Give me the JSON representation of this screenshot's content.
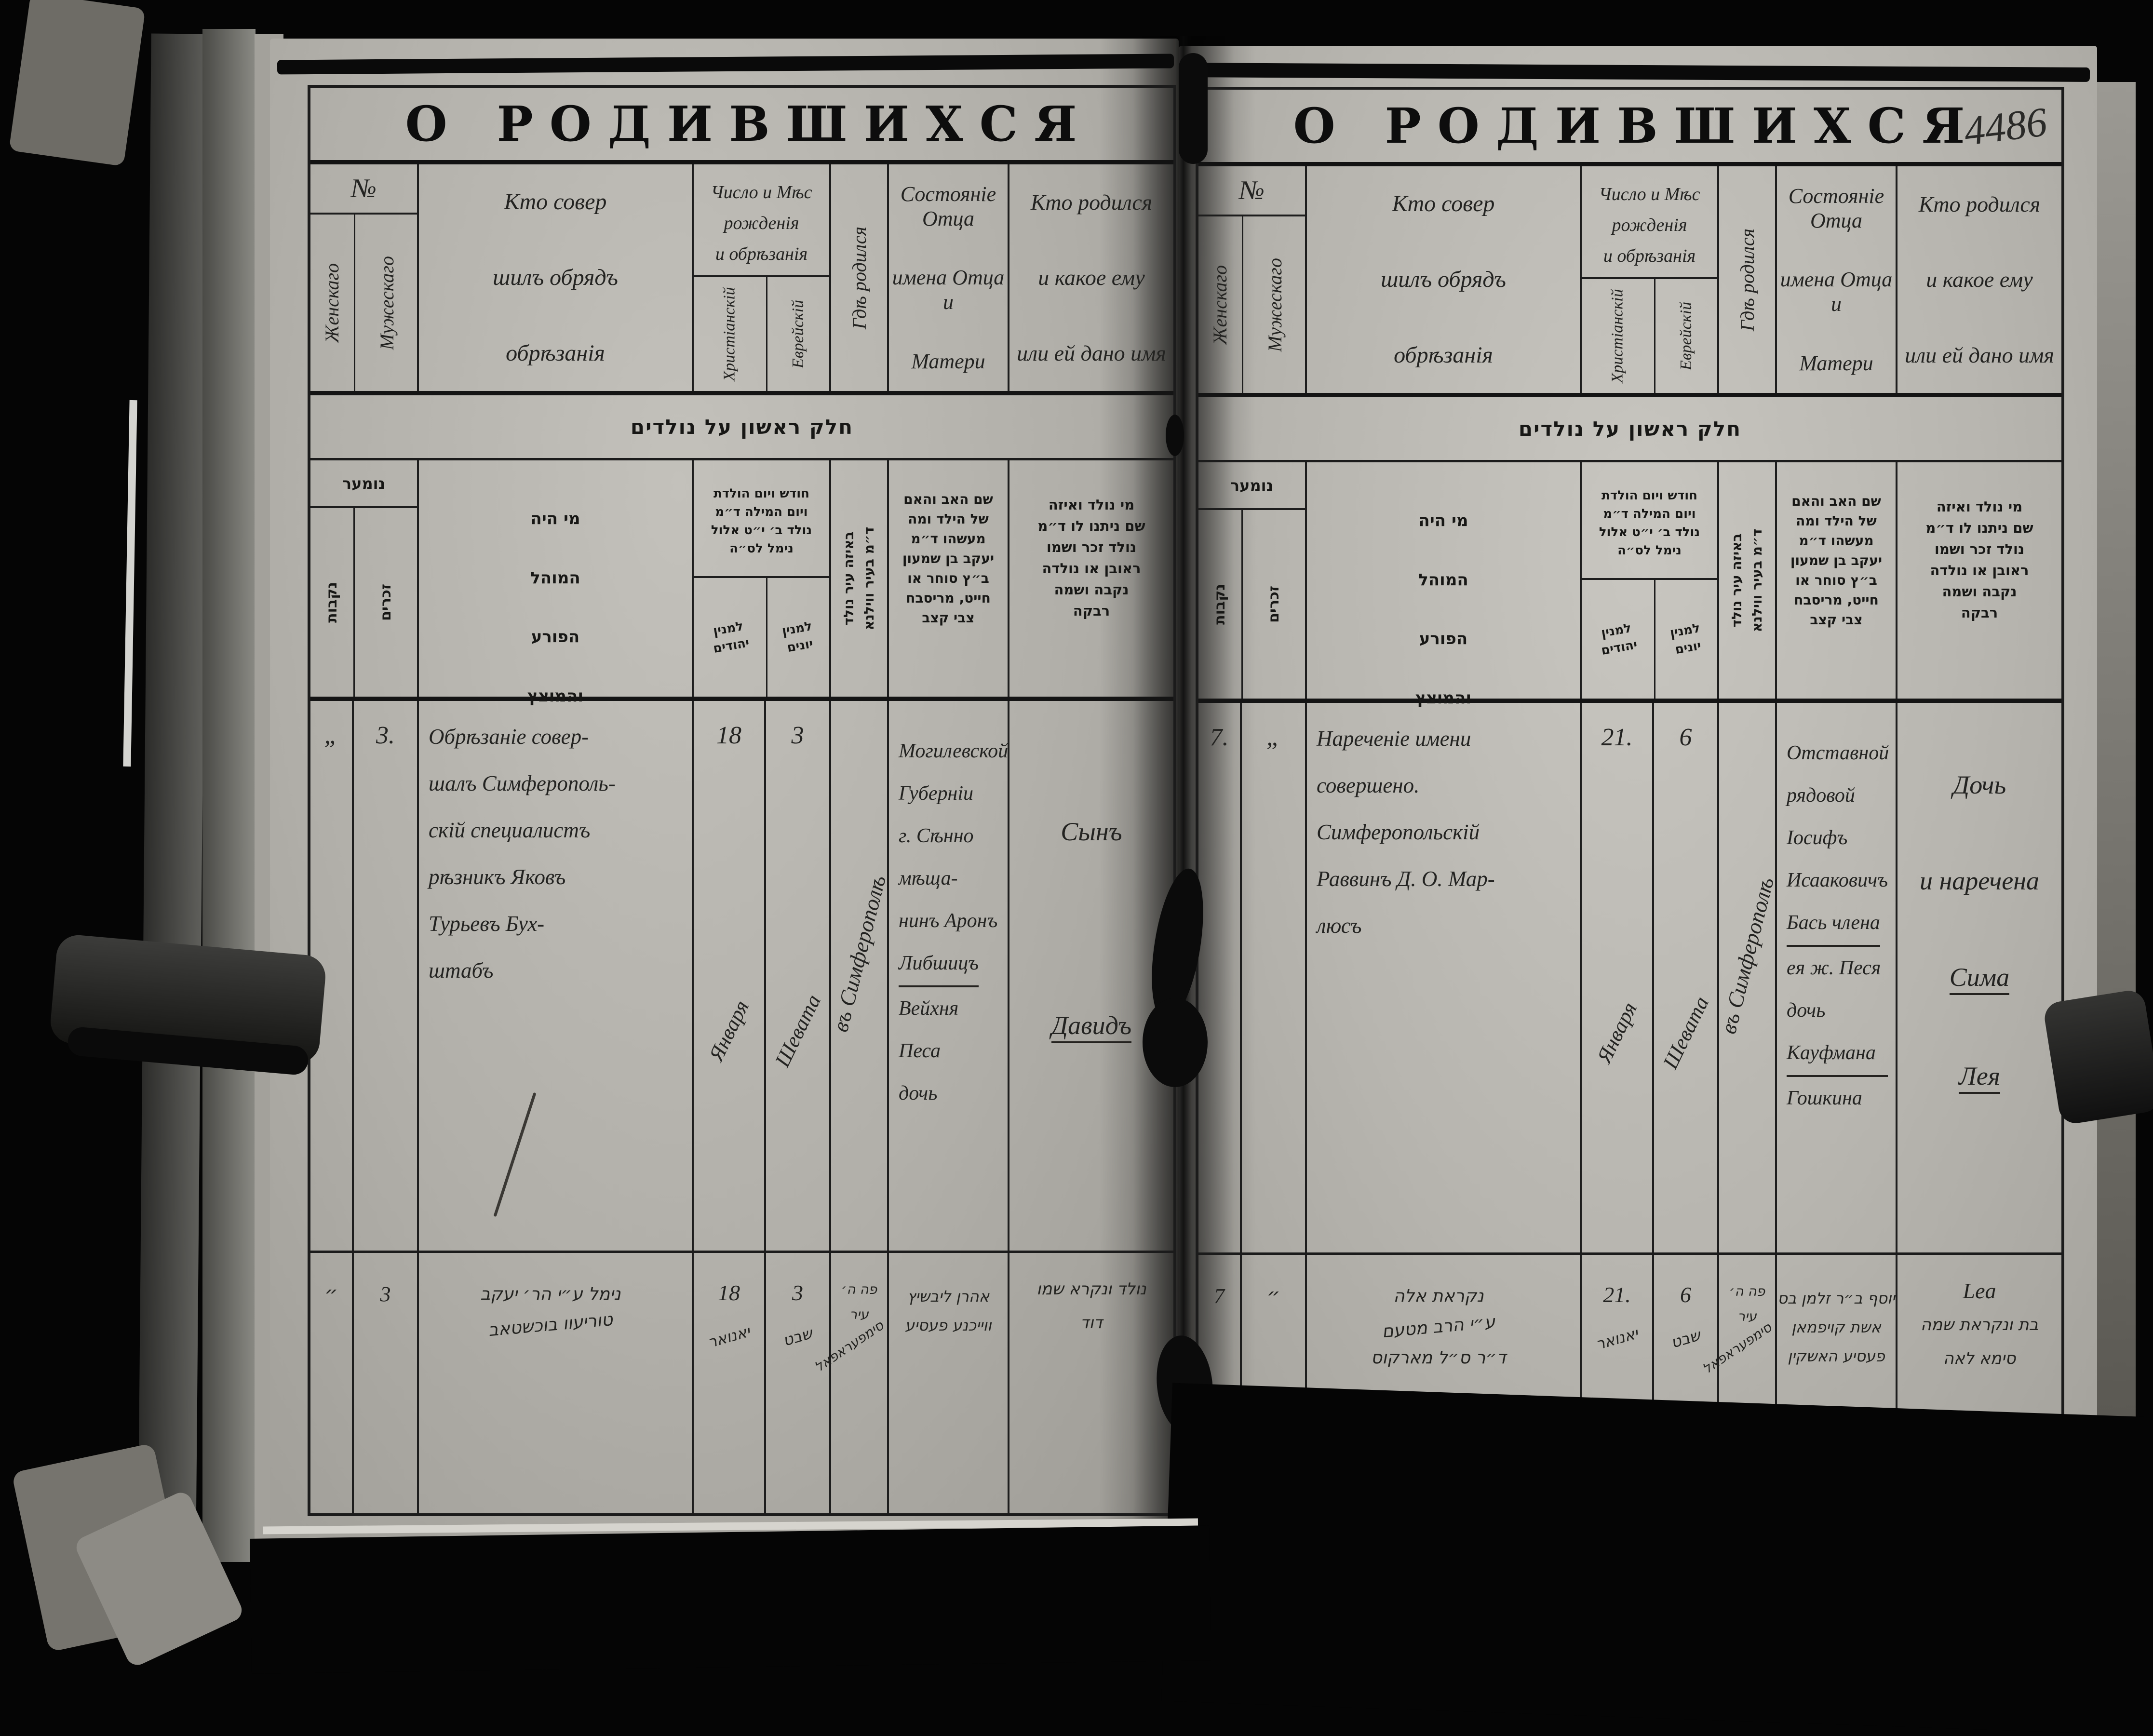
{
  "titles": {
    "main": "О РОДИВШИХСЯ",
    "page_number": "4486"
  },
  "colors": {
    "background": "#050505",
    "paper": "#b7b5af",
    "ink": "#232321",
    "line": "#1b1b1b"
  },
  "russian_header": {
    "no": "№",
    "female": "Женскаго",
    "male": "Мужескаго",
    "mohel_lines": [
      "Кто совер",
      "шилъ обрядъ",
      "обрѣзанія"
    ],
    "date_lines": [
      "Число и Мѣс",
      "рожденія",
      "и обрѣзанія"
    ],
    "christian": "Христіанскій",
    "jewish": "Еврейскій",
    "where": "Гдѣ родился",
    "father_lines": [
      "Состояніе Отца",
      "имена Отца и",
      "Матери"
    ],
    "child_lines": [
      "Кто родился",
      "и какое ему",
      "или ей дано имя"
    ]
  },
  "hebrew_header": {
    "band": "חלק ראשון על נולדים",
    "numer": "נומער",
    "female": "נקבות",
    "male": "זכרים",
    "mohel_lines": [
      "מי היה",
      "המוהל",
      "הפורע",
      "והמוצץ"
    ],
    "date_lines": [
      "חודש ויום הולדת",
      "ויום המילה ד״מ",
      "נולד ב׳ י״ט אלול",
      "נימל לס״ה"
    ],
    "jewish_count_lines": [
      "למנין",
      "יהודים"
    ],
    "gentile_count_lines": [
      "למנין",
      "יונים"
    ],
    "where_lines": [
      "באיזה עיר נולד",
      "ד״מ בעיר ווילנא"
    ],
    "father_lines": [
      "שם האב והאם",
      "של הילד ומה",
      "מעשהו ד״מ",
      "יעקב בן שמעון",
      "ב״ץ סוחר או",
      "חייט, מריסבח",
      "צבי קצב"
    ],
    "child_lines": [
      "מי נולד ואיזה",
      "שם ניתנו לו ד״מ",
      "נולד זכר ושמו",
      "ראובן או נולדה",
      "נקבה ושמה",
      "רבקה"
    ]
  },
  "left_page": {
    "rows": [
      {
        "female_no": "„",
        "male_no": "3.",
        "mohel_lines": [
          "Обрѣзаніе совер-",
          "шалъ Симферополь-",
          "скій специалистъ",
          "рѣзникъ Яковъ",
          "Турьевъ Бух-",
          "штабъ"
        ],
        "christian_day": "18",
        "christian_month": "Января",
        "jewish_day": "3",
        "jewish_month": "Шевата",
        "where": "въ Симферополѣ",
        "father_lines": [
          "Могилевской",
          "Губерніи",
          "г. Сѣнно мѣща-",
          "нинъ Аронъ",
          "Либшицъ",
          "Вейхня Песа",
          "дочь"
        ],
        "father_lines_u": [
          4
        ],
        "child_lines": [
          "Сынъ",
          "Давидъ"
        ],
        "child_lines_u": [
          1
        ]
      },
      {
        "female_no": "״",
        "male_no": "3",
        "mohel_lines": [
          "נימל ע״י הר׳ יעקב",
          "טוריעוו בוכשטאב"
        ],
        "christian_day": "18",
        "christian_month": "יאנואר",
        "jewish_day": "3",
        "jewish_month": "שבט",
        "where_lines": [
          "פה ה׳",
          "עיר",
          "סימפעראפאל"
        ],
        "father_lines": [
          "אהרן ליבשיץ",
          "ווייכנע פעסיע"
        ],
        "child_lines": [
          "נולד ונקרא שמו",
          "דוד"
        ]
      }
    ]
  },
  "right_page": {
    "rows": [
      {
        "female_no": "7.",
        "male_no": "„",
        "mohel_lines": [
          "Нареченіе имени",
          "совершено.",
          "Симферопольскій",
          "Раввинъ Д. О. Мар-",
          "люсъ"
        ],
        "christian_day": "21.",
        "christian_month": "Января",
        "jewish_day": "6",
        "jewish_month": "Шевата",
        "where": "въ Симферополѣ",
        "father_lines": [
          "Отставной",
          "рядовой Іосифъ",
          "Исааковичъ",
          "Бась члена",
          "ея ж. Песя",
          "дочь Кауфмана",
          "Гошкина"
        ],
        "father_lines_u": [
          3,
          5
        ],
        "child_lines": [
          "Дочь",
          "и наречена",
          "Сима",
          "Лея"
        ],
        "child_lines_u": [
          2,
          3
        ]
      },
      {
        "female_no": "7",
        "male_no": "״",
        "mohel_lines": [
          "נקראת אלה",
          "ע״י הרב מטעם",
          "ד״ר ס״ל מארקוס"
        ],
        "christian_day": "21.",
        "christian_month": "יאנואר",
        "jewish_day": "6",
        "jewish_month": "שבט",
        "where_lines": [
          "פה ה׳",
          "עיר",
          "סימפעראפאל"
        ],
        "father_lines": [
          "יוסף ב״ר זלמן בס",
          "אשת קויפמאן",
          "פעסיע האשקין"
        ],
        "child_lines": [
          "Lea",
          "בת ונקראת שמה",
          "סימא לאה"
        ]
      }
    ]
  }
}
